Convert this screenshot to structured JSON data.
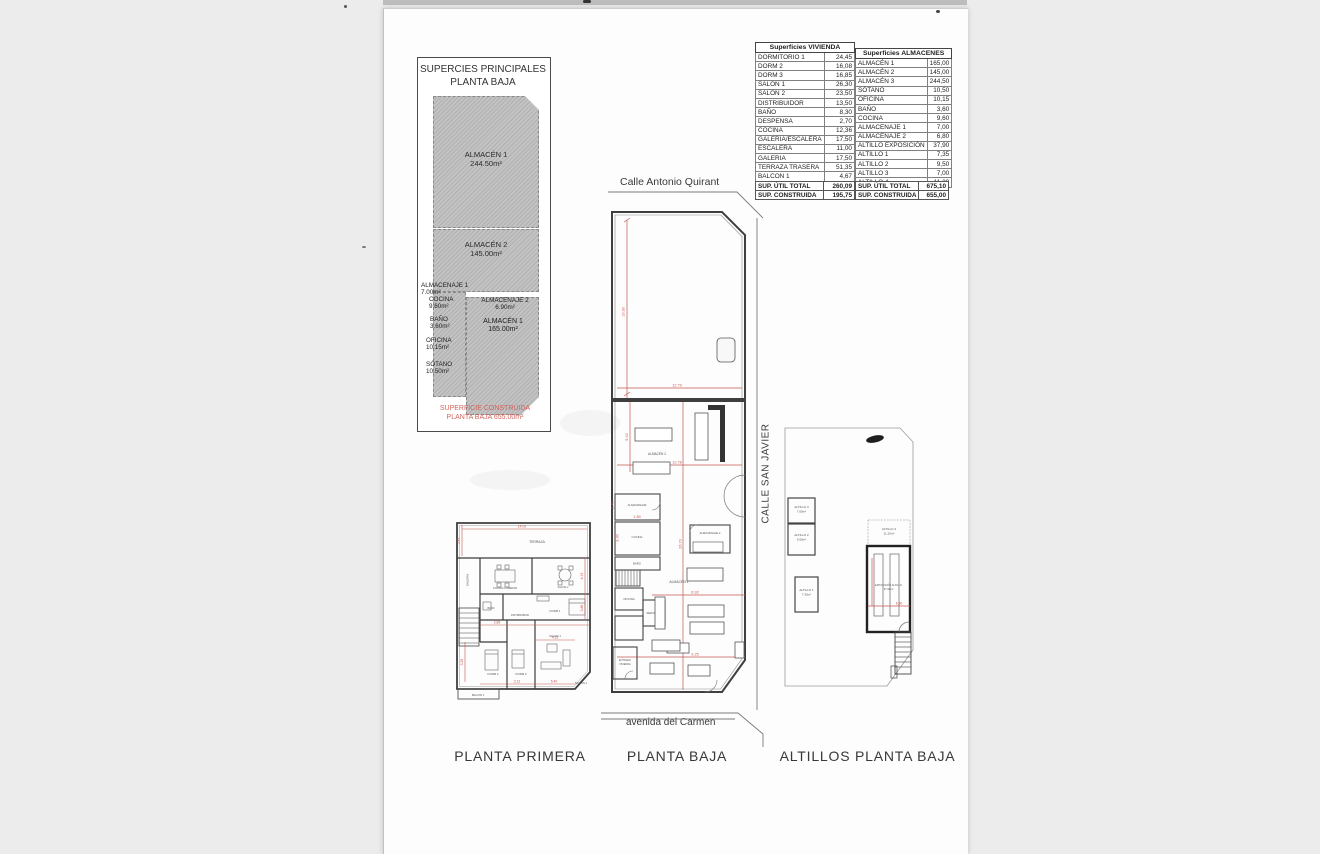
{
  "page": {
    "background": "#ececec",
    "paper_color": "#fdfdfd",
    "dimension_red": "#c4574e"
  },
  "summary_box": {
    "title1": "SUPERCIES PRINCIPALES",
    "title2": "PLANTA BAJA",
    "almacen1_top": {
      "name": "ALMACÉN 1",
      "area": "244.50m²"
    },
    "almacen2": {
      "name": "ALMACÉN 2",
      "area": "145.00m²"
    },
    "almacenaje1": {
      "name": "ALMACENAJE 1",
      "area": "7.00m²"
    },
    "cocina": {
      "name": "COCINA",
      "area": "9.60m²"
    },
    "bano": {
      "name": "BAÑO",
      "area": "3.60m²"
    },
    "almacenaje2": {
      "name": "ALMACENAJE 2",
      "area": "6.90m²"
    },
    "almacen1_mid": {
      "name": "ALMACÉN 1",
      "area": "165.00m²"
    },
    "oficina": {
      "name": "OFICINA",
      "area": "10.15m²"
    },
    "sotano": {
      "name": "SÓTANO",
      "area": "10.50m²"
    },
    "footer1": "SUPERFICIE CONSTRUIDA",
    "footer2": "PLANTA BAJA 655.00m²"
  },
  "tables": {
    "vivienda": {
      "title": "Superficies VIVIENDA",
      "rows": [
        [
          "DORMITORIO 1",
          "24,45"
        ],
        [
          "DORM 2",
          "16,08"
        ],
        [
          "DORM 3",
          "16,85"
        ],
        [
          "SALON 1",
          "26,30"
        ],
        [
          "SALON 2",
          "23,50"
        ],
        [
          "DISTRIBUIDOR",
          "13,50"
        ],
        [
          "BAÑO",
          "8,30"
        ],
        [
          "DESPENSA",
          "2,70"
        ],
        [
          "COCINA",
          "12,36"
        ],
        [
          "GALERIA/ESCALERA",
          "17,50"
        ],
        [
          "ESCALERA",
          "11,00"
        ],
        [
          "GALERIA",
          "17,50"
        ],
        [
          "TERRAZA TRASERA",
          "51,35"
        ],
        [
          "BALCON 1",
          "4,67"
        ],
        [
          "BALCON 2",
          "13,60"
        ]
      ],
      "totals": [
        [
          "SUP. ÚTIL TOTAL",
          "260,09"
        ],
        [
          "SUP. CONSTRUIDA",
          "195,75"
        ]
      ]
    },
    "almacenes": {
      "title": "Superficies ALMACENES",
      "rows": [
        [
          "ALMACÉN 1",
          "165,00"
        ],
        [
          "ALMACÉN 2",
          "145,00"
        ],
        [
          "ALMACÉN 3",
          "244,50"
        ],
        [
          "SÓTANO",
          "10,50"
        ],
        [
          "OFICINA",
          "10,15"
        ],
        [
          "BAÑO",
          "3,60"
        ],
        [
          "COCINA",
          "9,60"
        ],
        [
          "ALMACENAJE 1",
          "7,00"
        ],
        [
          "ALMACENAJE 2",
          "6,80"
        ],
        [
          "ALTILLO EXPOSICIÓN",
          "37,90"
        ],
        [
          "ALTILLO 1",
          "7,35"
        ],
        [
          "ALTILLO 2",
          "9,50"
        ],
        [
          "ALTILLO 3",
          "7,00"
        ],
        [
          "ALTILLO 4",
          "11,20"
        ]
      ],
      "totals": [
        [
          "SUP. ÚTIL TOTAL",
          "675,10"
        ],
        [
          "SUP. CONSTRUIDA",
          "655,00"
        ]
      ]
    }
  },
  "streets": {
    "top": "Calle Antonio Quirant",
    "right": "CALLE SAN JAVIER",
    "bottom": "avenida del Carmen"
  },
  "plans": {
    "planta_primera": {
      "title": "PLANTA PRIMERA",
      "rooms": {
        "terraza": "TERRAZA",
        "galeria": "GALERIA",
        "cocina_comedor": "COCINA COMEDOR",
        "salon2": "SALON 2",
        "dorm1": "DORM 1",
        "bano": "BAÑO",
        "distribuidor": "DISTRIBUIDOR",
        "dorm2": "DORM 2",
        "dorm3": "DORM 3",
        "salon1": "SALON 1",
        "balcon1": "BALCON 1",
        "balcon2": "BALCON 2"
      },
      "dims": {
        "d1": "14.02",
        "d2": "3.43",
        "d3": "4.51",
        "d4": "2.89",
        "d5": "3.88",
        "d6": "4.19",
        "d7": "3.12",
        "d8": "5.40",
        "d9": "3.29"
      }
    },
    "planta_baja": {
      "title": "PLANTA BAJA",
      "rooms": {
        "almacen2": "ALMACÉN 2",
        "almacenaje": "ALMACENAJE",
        "cocina": "COCINA",
        "bano": "BAÑO",
        "oficina": "OFICINA",
        "servicios": "SERVICIOS",
        "almacenaje2": "ALMACENAJE 2",
        "almacen1": "ALMACÉN 1",
        "entrada1": "ENTRADA",
        "entrada2": "VIVIENDA"
      },
      "dims": {
        "d1": "19.30",
        "d2": "12.79",
        "d3": "12.78",
        "d4": "9.42",
        "d5": "26.70",
        "d6": "6.92",
        "d7": "9.25",
        "d8": "1.80",
        "d9": "3.30",
        "d10": "2.40"
      }
    },
    "altillos": {
      "title": "ALTILLOS PLANTA BAJA",
      "boxes": {
        "altillo3": {
          "name": "ALTILLO 3",
          "area": "7.00m²"
        },
        "altillo2": {
          "name": "ALTILLO 2",
          "area": "9.50m²"
        },
        "altillo1": {
          "name": "ALTILLO 1",
          "area": "7.35m²"
        },
        "altillo4": {
          "name": "ALTILLO 4",
          "area": "11.20m²"
        },
        "exposicion": {
          "name": "EXPOSICIÓN ALTILLO",
          "area": "37.90m²"
        }
      },
      "dims": {
        "d1": "6.30"
      }
    }
  }
}
